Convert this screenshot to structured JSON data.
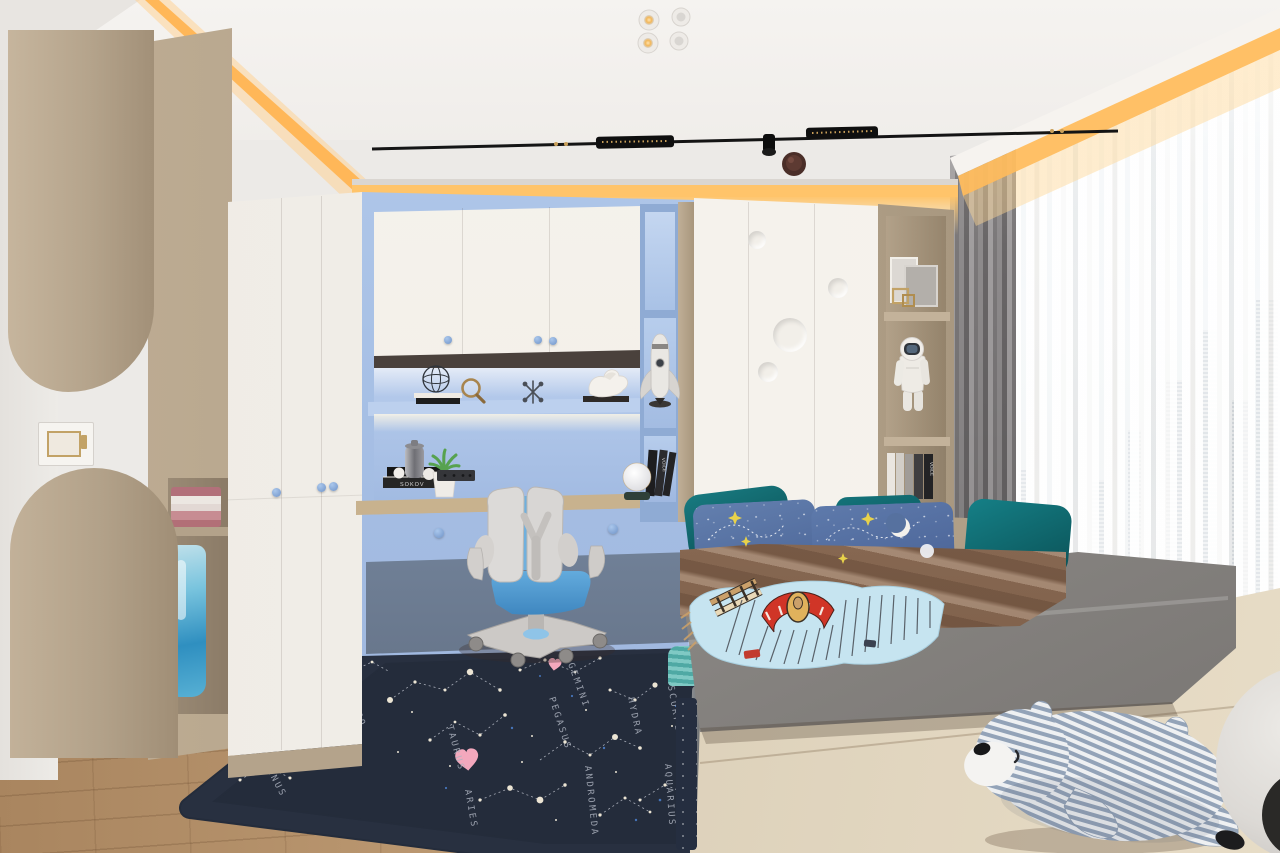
{
  "scene": {
    "type": "3d-interior-render",
    "room": "kids-bedroom",
    "style": "modern-scandinavian",
    "time_of_day": "day"
  },
  "rug": {
    "labels": [
      "ERIDANUS",
      "LEO",
      "TAURUS",
      "ARIES",
      "PEGASUS",
      "GEMINI",
      "HYDRA",
      "SCORPIO",
      "ANDROMEDA",
      "AQUARIUS"
    ]
  },
  "books": {
    "desk_stack_spine": "SOKOV",
    "case_spine": "VOICE",
    "cubby_spine": "VOICE"
  },
  "palette": {
    "cove_glow": "#ffbe63",
    "ceiling": "#f3f1ee",
    "wall": "#eceae6",
    "wood_tan": "#b5a48d",
    "cabinet_white": "#f4f1ea",
    "unit_blue": "#a6c0e6",
    "desk_top_wood": "#cbb493",
    "chair_seat_blue": "#5ca6da",
    "mattress_gray": "#8f8c89",
    "blanket_brown": "#8a6b55",
    "pillow_teal": "#11646a",
    "pillow_blue": "#5b77a6",
    "throw_blue": "#c5e4f0",
    "rug_navy": "#242c3b",
    "floor_wood": "#c2a07a",
    "curtain_gray": "#8b8889",
    "sheer_white": "#f7f5f2",
    "sky_blue": "#cfe3f2",
    "plush_stripe_blue": "#93a3b8"
  },
  "objects": [
    "recessed-spotlights",
    "track-light",
    "cove-lighting",
    "wardrobe",
    "desk-unit",
    "study-chair",
    "bookshelf",
    "rocket-model",
    "astronaut-figurine",
    "globe-lamp",
    "potted-plant",
    "bed",
    "star-pillows",
    "constellation-rug",
    "sheer-curtains",
    "city-view",
    "plush-bear",
    "towels",
    "hanging-garment",
    "light-switch",
    "smoke-detector",
    "picture-frames",
    "ball"
  ]
}
